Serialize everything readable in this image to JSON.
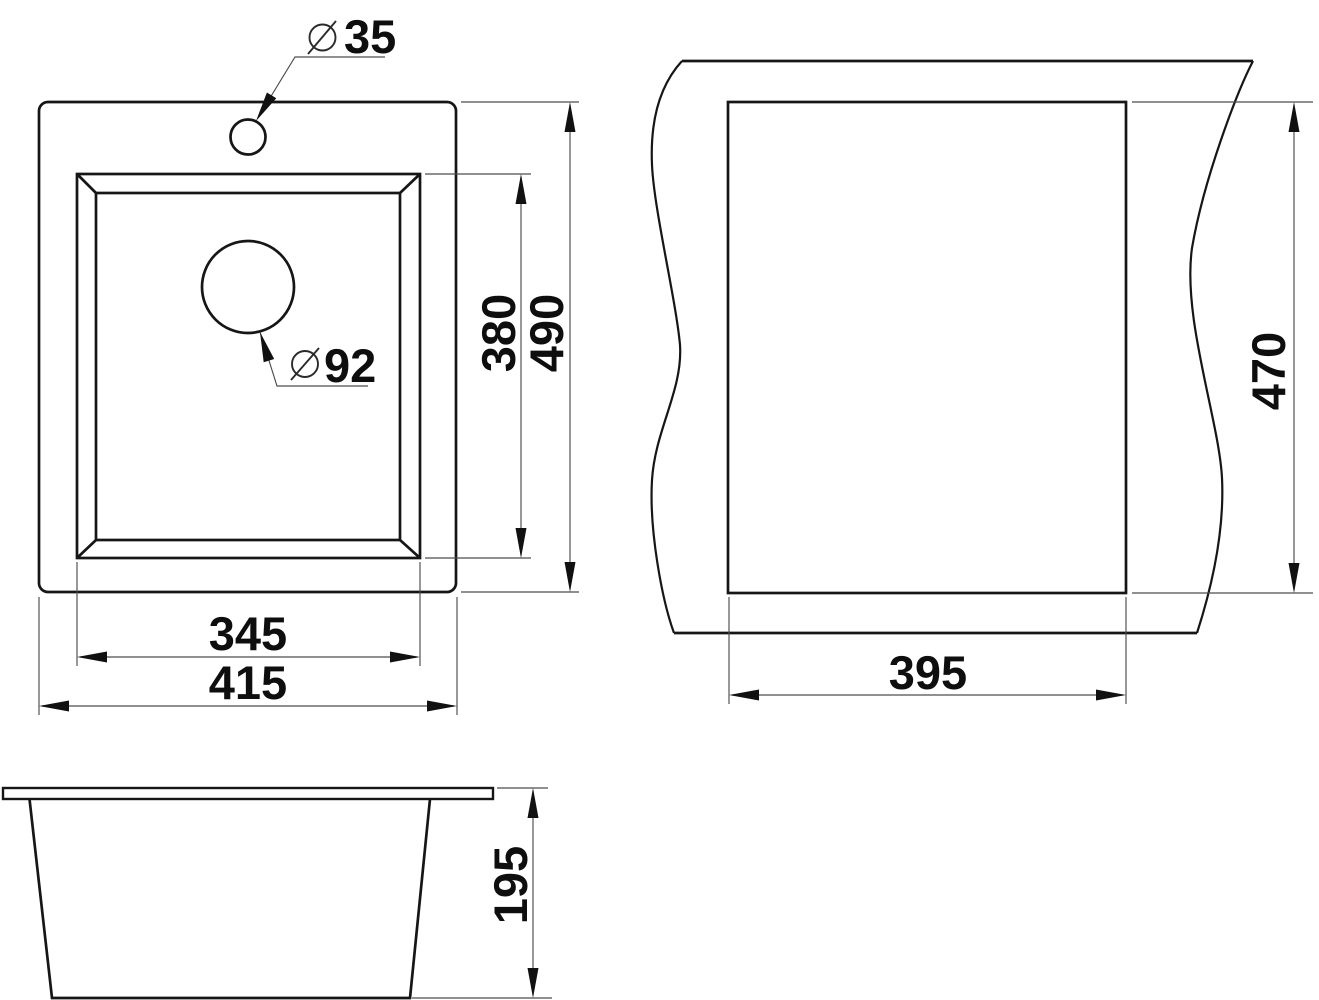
{
  "title": "Sink installation dimension drawing",
  "colors": {
    "background": "#ffffff",
    "object_line": "#161616",
    "dimension_line": "#4d4d4d",
    "text": "#0e0e0e"
  },
  "plan_view": {
    "description": "top view of sink with faucet hole, bowl and drain hole",
    "faucet_hole": {
      "symbol": "⌀",
      "diameter": "35"
    },
    "drain_hole": {
      "symbol": "⌀",
      "diameter": "92"
    },
    "bowl_length": "380",
    "overall_length": "490",
    "bowl_width": "345",
    "overall_width": "415"
  },
  "cutout_view": {
    "description": "worktop cutout with break lines",
    "cutout_length": "470",
    "cutout_width": "395"
  },
  "section_view": {
    "description": "front elevation of bowl with rim",
    "bowl_depth": "195"
  }
}
